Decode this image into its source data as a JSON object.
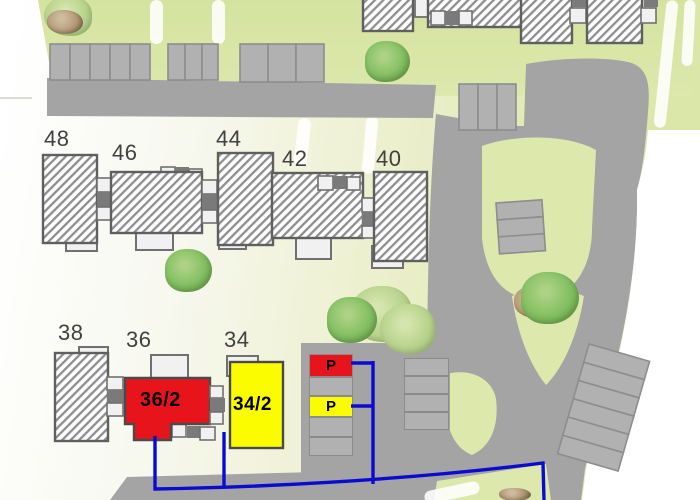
{
  "site": {
    "house_numbers": [
      "48",
      "46",
      "44",
      "42",
      "40",
      "38",
      "36",
      "34"
    ],
    "units": [
      {
        "label": "36/2",
        "color": "#e8141c"
      },
      {
        "label": "34/2",
        "color": "#ffff00"
      }
    ],
    "parking_markers": [
      {
        "label": "P",
        "color": "#e8141c"
      },
      {
        "label": "P",
        "color": "#ffff00"
      }
    ],
    "colors": {
      "unit_red": "#e8141c",
      "unit_yellow": "#fcfc00",
      "boundary_blue": "#0b0bd0",
      "road_gray": "#a4a4a4",
      "stall_gray": "#b1b1b1",
      "lawn_green": "#dde8ad",
      "tree_green": "#7dbd5b",
      "building_outline": "#5f5f5f",
      "connector_gray": "#7a7a7a",
      "extension_white": "#f1f1f1"
    }
  }
}
